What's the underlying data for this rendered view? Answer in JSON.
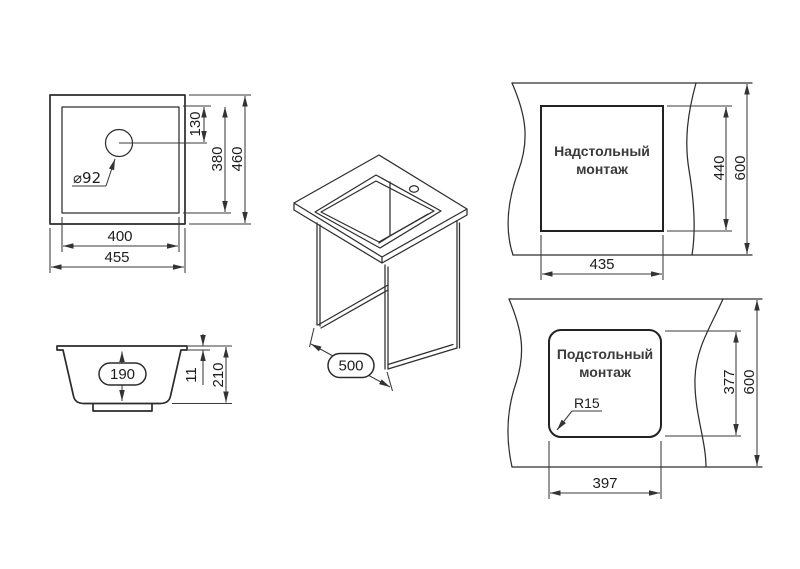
{
  "colors": {
    "background": "#ffffff",
    "object_line": "#2b2b2b",
    "dimension_line": "#3a3a3a",
    "text": "#1d1d1d",
    "mount_label": "#3a3a3a"
  },
  "plan": {
    "hole_label": "⌀92",
    "hole_offset": "130",
    "inner_height": "380",
    "outer_height": "460",
    "inner_width": "400",
    "outer_width": "455"
  },
  "section": {
    "depth": "190",
    "rim": "11",
    "height": "210"
  },
  "iso": {
    "width": "500"
  },
  "topmount": {
    "line1": "Надстольный",
    "line2": "монтаж",
    "width": "435",
    "height": "440",
    "counter": "600"
  },
  "undermount": {
    "line1": "Подстольный",
    "line2": "монтаж",
    "width": "397",
    "height": "377",
    "counter": "600",
    "radius": "R15"
  }
}
